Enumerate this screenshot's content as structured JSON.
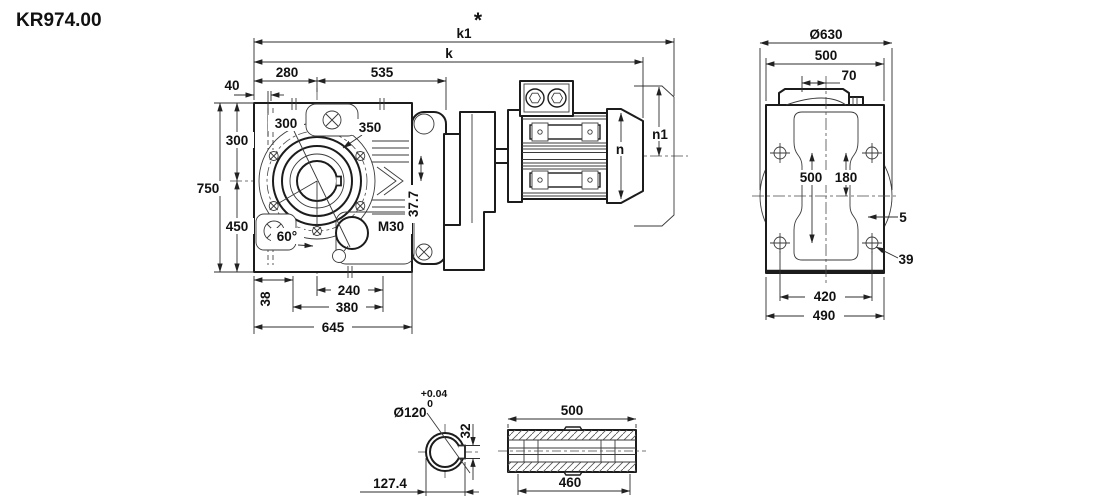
{
  "title": "KR974.00",
  "footnote_marker": "*",
  "views": {
    "front": {
      "k1": "k1",
      "k": "k",
      "w280": "280",
      "w535": "535",
      "w40": "40",
      "h300": "300",
      "h750": "750",
      "h450": "450",
      "b38": "38",
      "b240": "240",
      "b380": "380",
      "b645": "645",
      "flange300": "300",
      "flange350": "350",
      "angle60": "60°",
      "plug": "M30",
      "offset377": "37.7",
      "n": "n",
      "n1": "n1"
    },
    "rear": {
      "d630": "Ø630",
      "w500": "500",
      "w70": "70",
      "i500": "500",
      "i180": "180",
      "t5": "5",
      "h39": "39",
      "b420": "420",
      "b490": "490"
    },
    "shaft_section": {
      "bore": "Ø120",
      "tol_plus": "+0.04",
      "tol_zero": "0",
      "key32": "32",
      "depth127": "127.4"
    },
    "shaft_side": {
      "len500": "500",
      "len460": "460"
    }
  }
}
